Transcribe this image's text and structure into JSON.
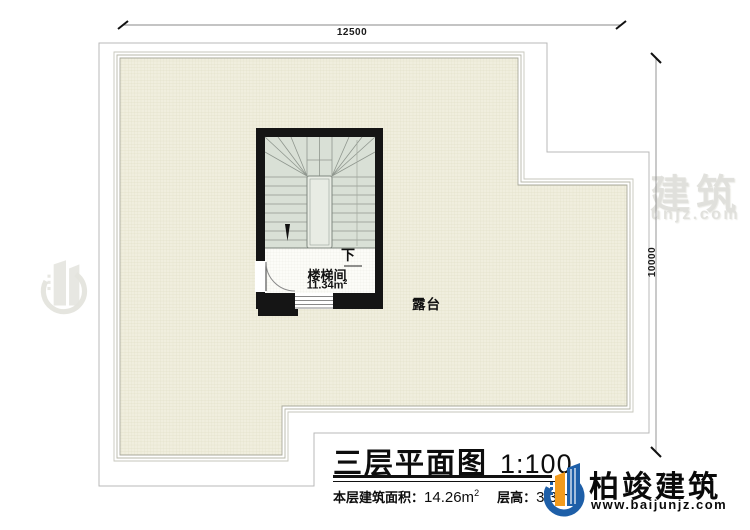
{
  "plan": {
    "dimensions": {
      "top": "12500",
      "right": "10000"
    },
    "stair_room": {
      "name": "楼梯间",
      "area_value": "11.34m",
      "area_sup": "2",
      "direction": "下"
    },
    "terrace_label": "露台"
  },
  "title_block": {
    "title": "三层平面图",
    "scale": "1:100",
    "area_label": "本层建筑面积：",
    "area_value": "14.26m",
    "area_sup": "2",
    "floor_height_label": "层高：",
    "floor_height_value": "3.3m"
  },
  "branding": {
    "logo_text": "柏竣建筑",
    "logo_url": "www.baijunjz.com"
  },
  "watermark": {
    "text": "柏竣建筑",
    "url": "www.baijunjz.com"
  },
  "colors": {
    "terrace_fill": "#f0eede",
    "wall": "#151515",
    "stair_fill": "#d9e0d6",
    "logo_blue": "#1e5fa8",
    "logo_orange": "#f29b1d"
  }
}
